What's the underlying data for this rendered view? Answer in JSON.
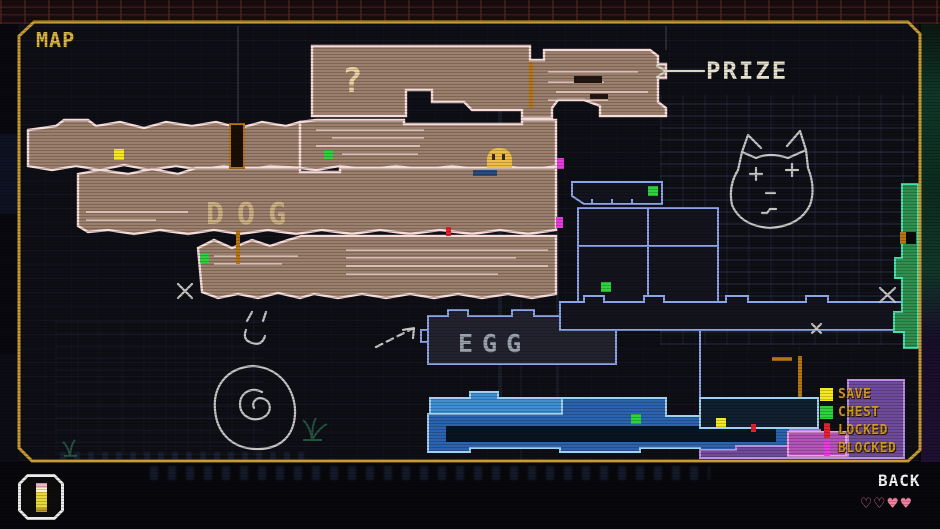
{
  "title": "MAP",
  "map_labels": {
    "question": "?",
    "prize": "PRIZE",
    "dog": "DOG",
    "egg": "EGG"
  },
  "legend": {
    "items": [
      {
        "label": "SAVE",
        "color": "#f6e821",
        "swatch": "square"
      },
      {
        "label": "CHEST",
        "color": "#2ed23c",
        "swatch": "square"
      },
      {
        "label": "LOCKED",
        "color": "#e5202f",
        "swatch": "bar"
      },
      {
        "label": "BLOCKED",
        "color": "#e83ce0",
        "swatch": "bar"
      }
    ],
    "text_color": "#d29b28"
  },
  "hud": {
    "back_label": "BACK",
    "hearts": {
      "chars": [
        "♡",
        "♡",
        "♥",
        "♥"
      ],
      "color": "#f27f9e"
    },
    "item": "pencil"
  },
  "colors": {
    "frame_gold": "#c89b35",
    "title_gold": "#d9b647",
    "tan_fill": "#9b7f6c",
    "tan_outline": "#f7dcd9",
    "blue_outline": "#8ca4e8",
    "dark_room_fill": "#14141e",
    "egg_room_fill": "#232330",
    "cyan_fill": "#2b63ae",
    "cyan_light": "#3f8fd4",
    "cyan_outline": "#9fd2f2",
    "tunnel_dark": "#0a1522",
    "green_fill": "#2e8f4e",
    "green_outline": "#43e3ae",
    "purple_fill": "#6f4b9b",
    "purple_outline": "#bd8fe3",
    "pink_fill": "#b254b8",
    "pink_outline": "#ef9fe0",
    "doodle_gray": "#c6c6c6",
    "doodle_cream": "#d6d6c2",
    "question_tan": "#ecd2a2",
    "dog_text": "#cdb083",
    "egg_text": "#9aa2ac",
    "prize_text": "#e6e2ce",
    "pipe_orange": "#b87513",
    "save_yellow": "#f6e821",
    "chest_green": "#2ed23c",
    "locked_red": "#e5202f",
    "blocked_magenta": "#e83ce0",
    "player_yellow": "#edbe4a"
  }
}
